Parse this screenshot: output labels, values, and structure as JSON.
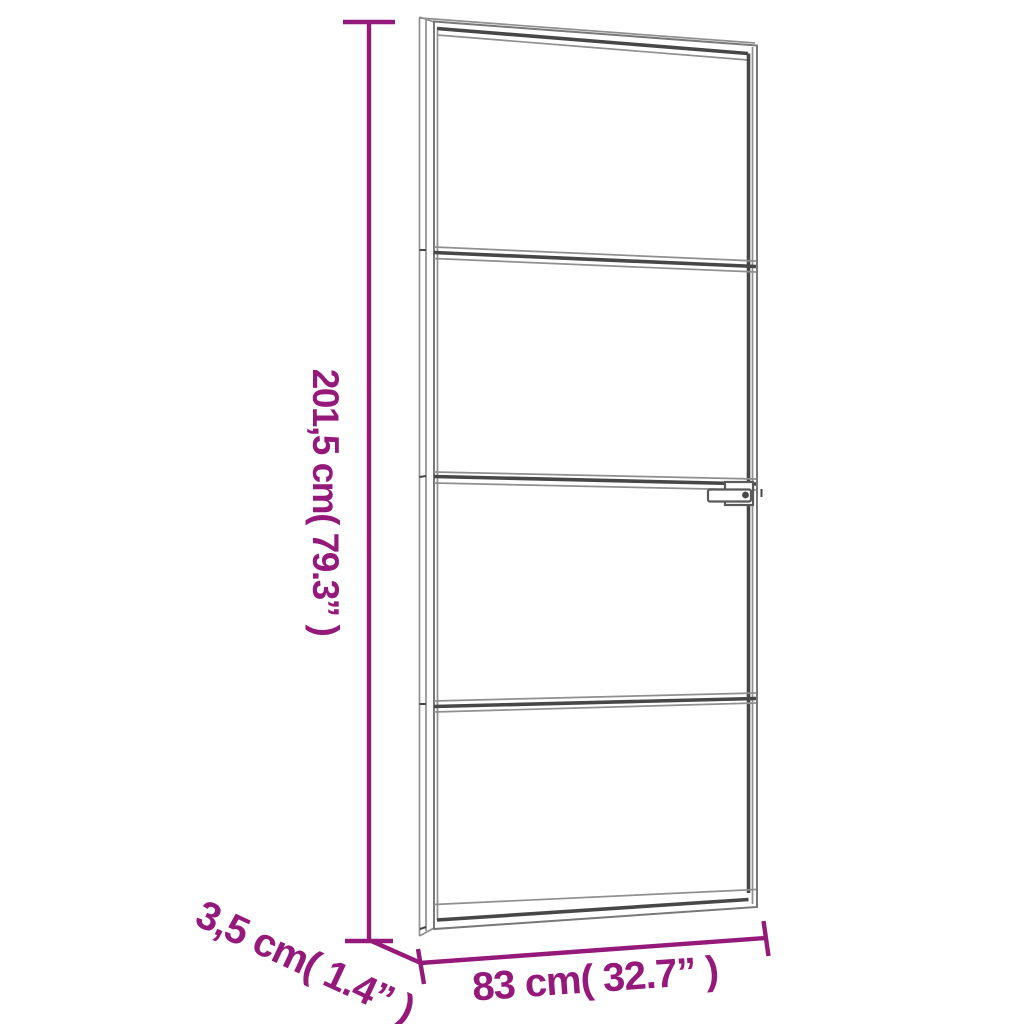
{
  "theme": {
    "bg": "#ffffff",
    "accent": "#95197b",
    "line_light": "#8f8f8f",
    "line_mid": "#787878",
    "line_dark": "#474747"
  },
  "diagram": {
    "kind": "product-dimension-diagram",
    "subject": "slim interior glass door with four glass panels, narrow frame and handle, shown in slight perspective",
    "dimensions": {
      "height": {
        "label": "201,5 cm( 79.3” )",
        "value_cm": "201,5 cm",
        "value_in": "79.3”"
      },
      "depth": {
        "label": "3,5 cm( 1.4” )",
        "value_cm": "3,5 cm",
        "value_in": "1.4”"
      },
      "width": {
        "label": "83 cm( 32.7” )",
        "value_cm": "83 cm",
        "value_in": "32.7”"
      }
    }
  }
}
